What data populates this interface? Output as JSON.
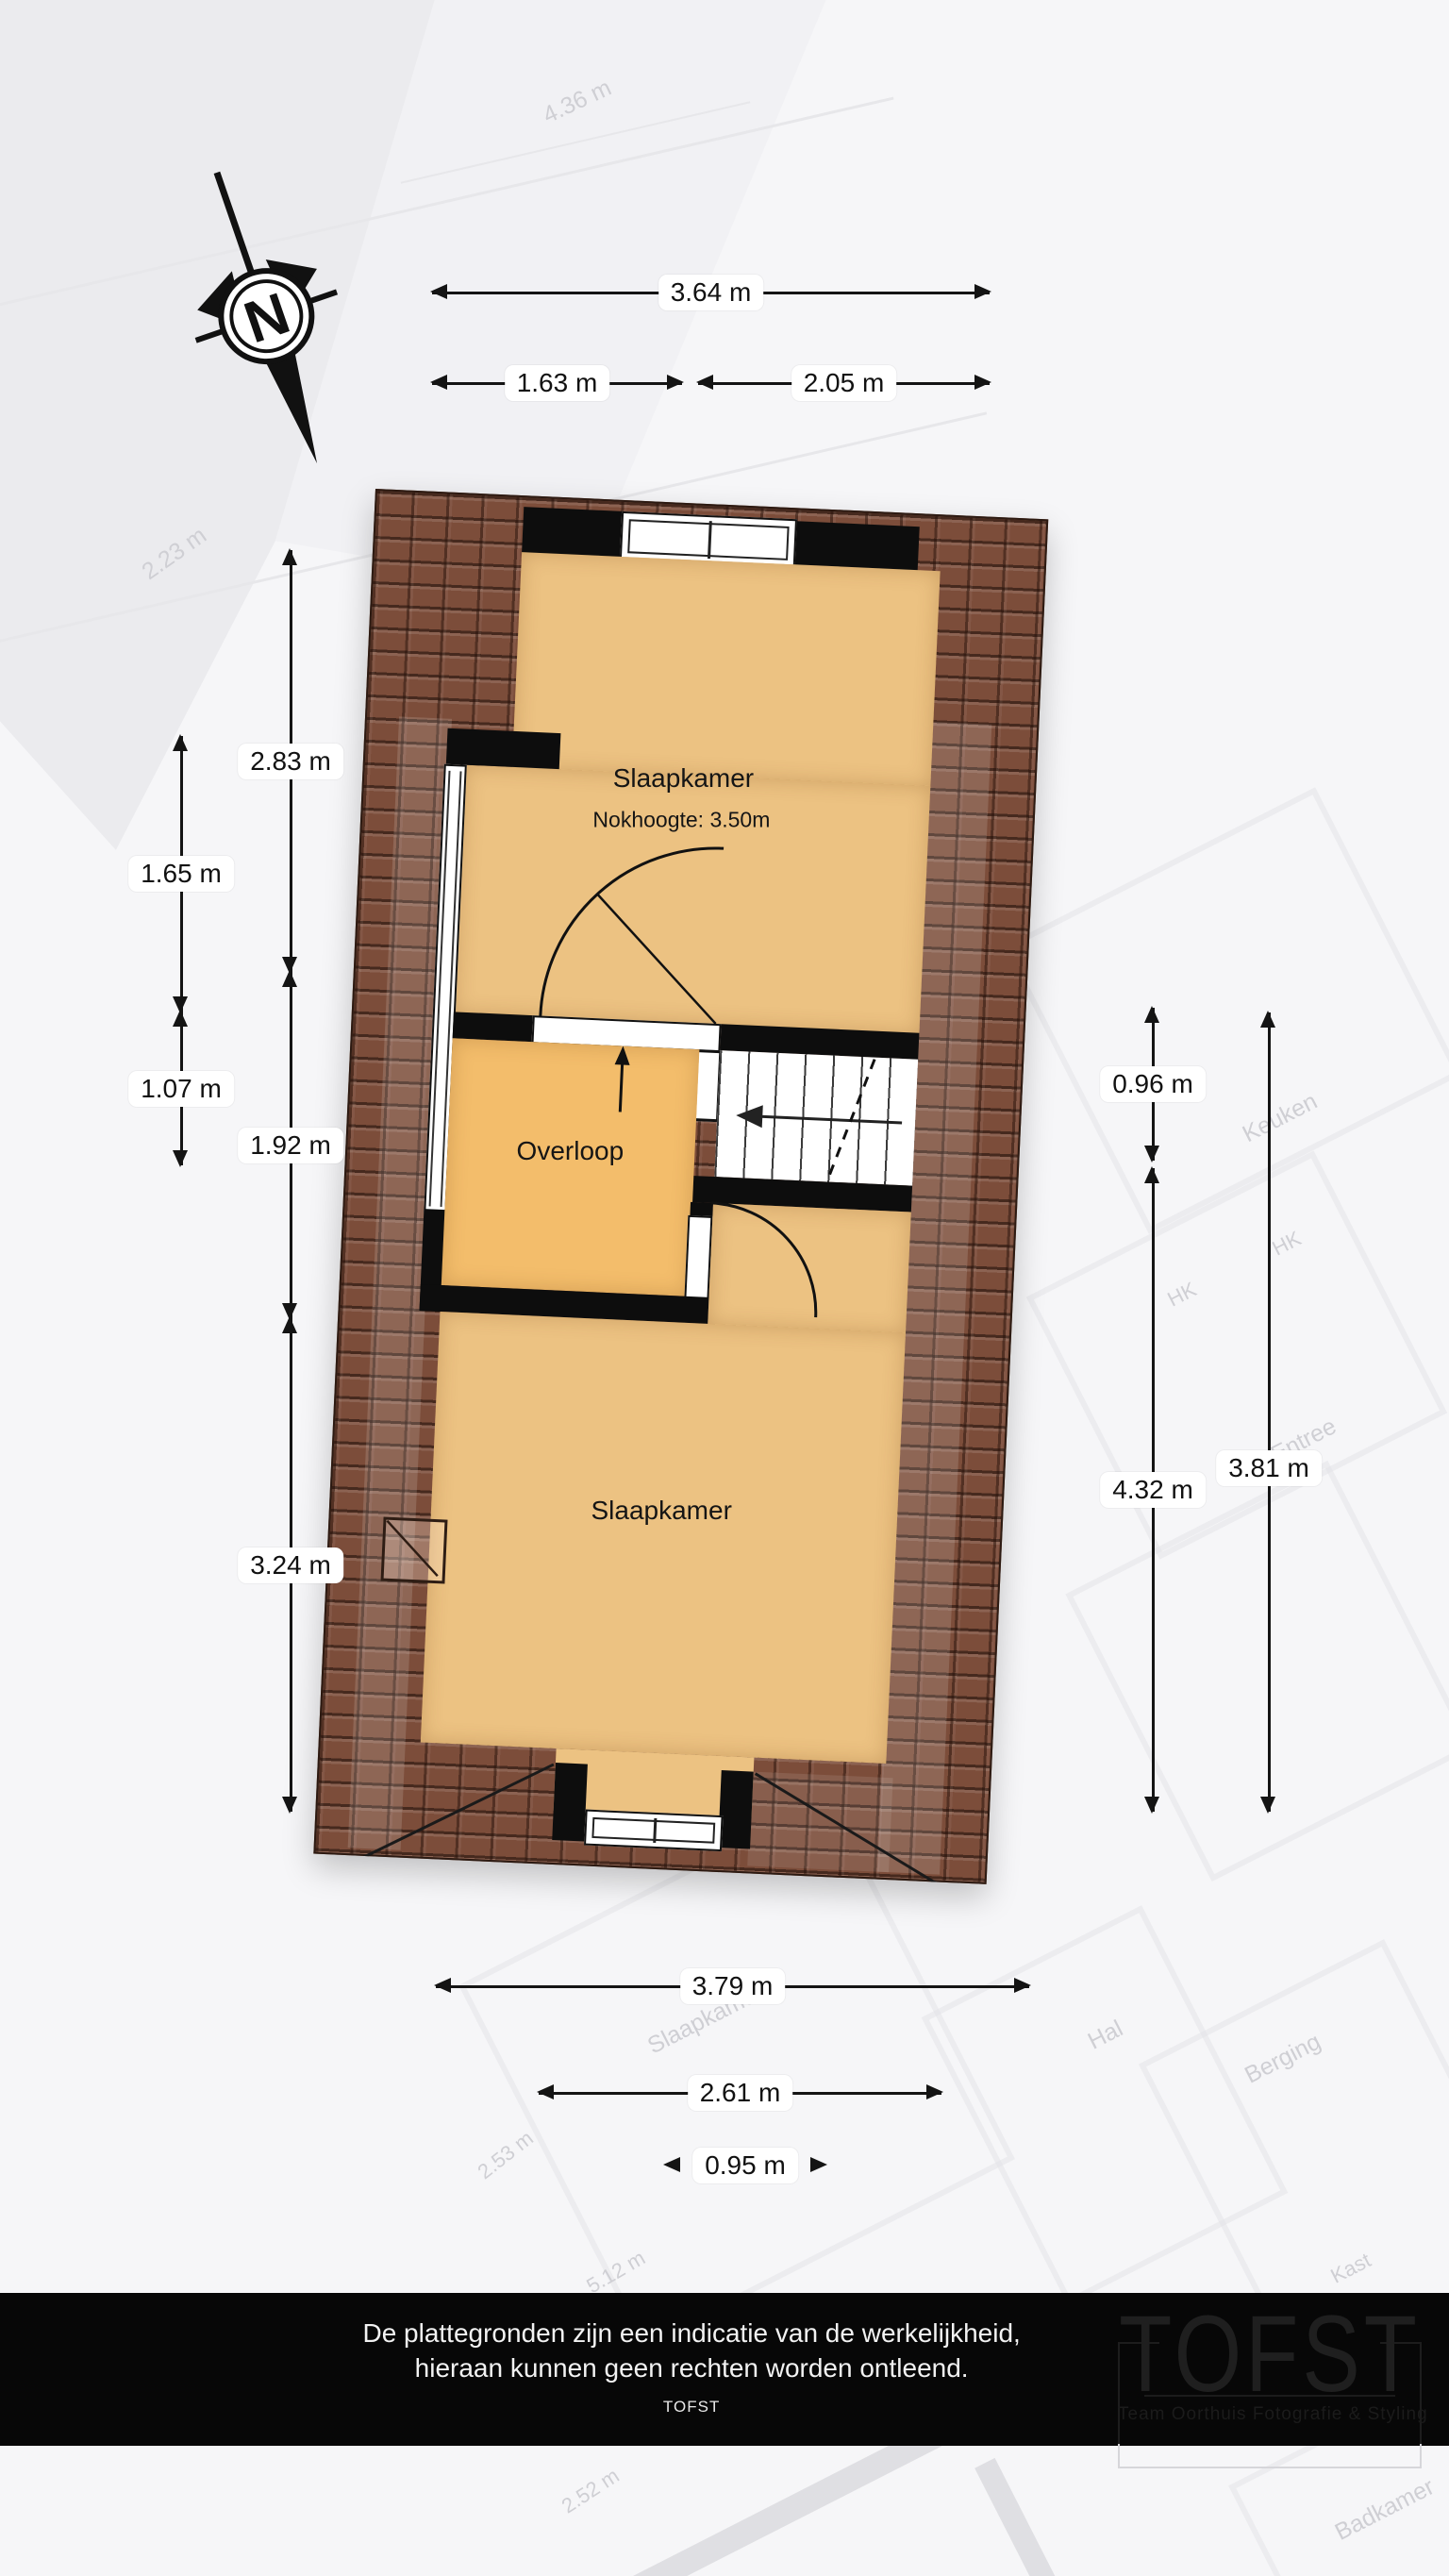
{
  "compass": {
    "label": "N"
  },
  "plan": {
    "rooms": {
      "bedroom_top": {
        "label": "Slaapkamer",
        "subtitle": "Nokhoogte: 3.50m"
      },
      "landing": {
        "label": "Overloop"
      },
      "bedroom_bottom": {
        "label": "Slaapkamer"
      }
    }
  },
  "dimensions": {
    "top": [
      {
        "label": "3.64 m"
      },
      {
        "label": "1.63 m"
      },
      {
        "label": "2.05 m"
      }
    ],
    "left": [
      {
        "label": "2.83 m"
      },
      {
        "label": "1.65 m"
      },
      {
        "label": "1.07 m"
      },
      {
        "label": "1.92 m"
      },
      {
        "label": "3.24 m"
      }
    ],
    "right": [
      {
        "label": "0.96 m"
      },
      {
        "label": "4.32 m"
      },
      {
        "label": "3.81 m"
      }
    ],
    "bottom": [
      {
        "label": "3.79 m"
      },
      {
        "label": "2.61 m"
      },
      {
        "label": "0.95 m"
      }
    ]
  },
  "background": {
    "labels": [
      {
        "text": "4.36 m"
      },
      {
        "text": "2.23 m"
      },
      {
        "text": "Keuken"
      },
      {
        "text": "HK"
      },
      {
        "text": "HK"
      },
      {
        "text": "Entree"
      },
      {
        "text": "Slaapkamer"
      },
      {
        "text": "Hal"
      },
      {
        "text": "Berging"
      },
      {
        "text": "2.53 m"
      },
      {
        "text": "5.12 m"
      },
      {
        "text": "Kast"
      },
      {
        "text": "2.52 m"
      },
      {
        "text": "Badkamer"
      }
    ]
  },
  "footer": {
    "disclaimer_line1": "De plattegronden zijn een indicatie van de werkelijkheid,",
    "disclaimer_line2": "hieraan kunnen geen rechten worden ontleend.",
    "brand": "TOFST"
  },
  "watermark": {
    "title": "TOFST",
    "subtitle": "Team Oorthuis Fotografie & Styling"
  },
  "colors": {
    "room_fill": "#ecc282",
    "landing_fill": "#f3bd6b",
    "roof_base": "#7c4d3a",
    "wall": "#0d0d0d",
    "footer_bg": "#070707",
    "label_bg": "#ffffff"
  }
}
